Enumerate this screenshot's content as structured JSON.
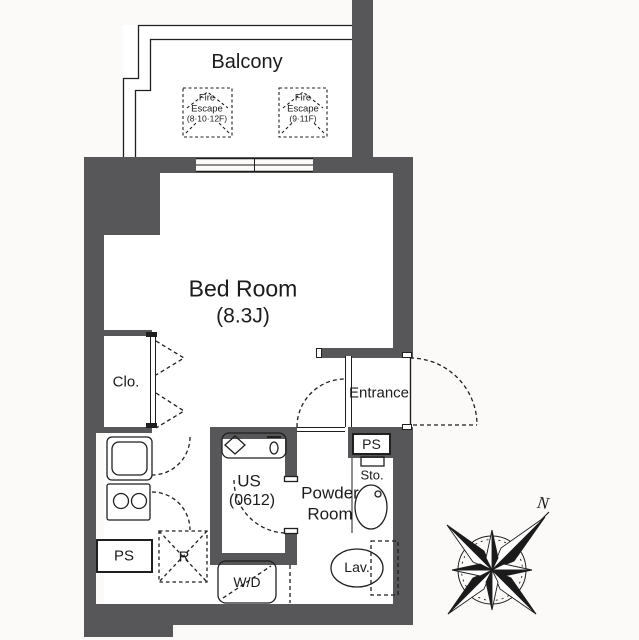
{
  "colors": {
    "wall": "#57575a",
    "line": "#1f1f1f",
    "floor": "#ffffff"
  },
  "rooms": {
    "balcony": {
      "label": "Balcony"
    },
    "bedroom": {
      "name": "Bed Room",
      "size": "(8.3J)"
    },
    "closet": {
      "label": "Clo."
    },
    "entrance": {
      "label": "Entrance"
    },
    "unit_bath": {
      "name": "US",
      "size": "(0612)"
    },
    "powder_room": {
      "name_line1": "Powder",
      "name_line2": "Room"
    }
  },
  "fixtures": {
    "fire_escape_left": {
      "line1": "Fire",
      "line2": "Escape",
      "line3": "(8·10·12F)"
    },
    "fire_escape_right": {
      "line1": "Fire",
      "line2": "Escape",
      "line3": "(9·11F)"
    },
    "pipe_space_left": {
      "label": "PS"
    },
    "pipe_space_entrance": {
      "label": "PS"
    },
    "storage": {
      "label": "Sto."
    },
    "lavatory": {
      "label": "Lav."
    },
    "refrigerator_space": {
      "label": "R"
    },
    "washer_dryer": {
      "label": "W/D"
    }
  },
  "compass": {
    "north_label": "N"
  }
}
